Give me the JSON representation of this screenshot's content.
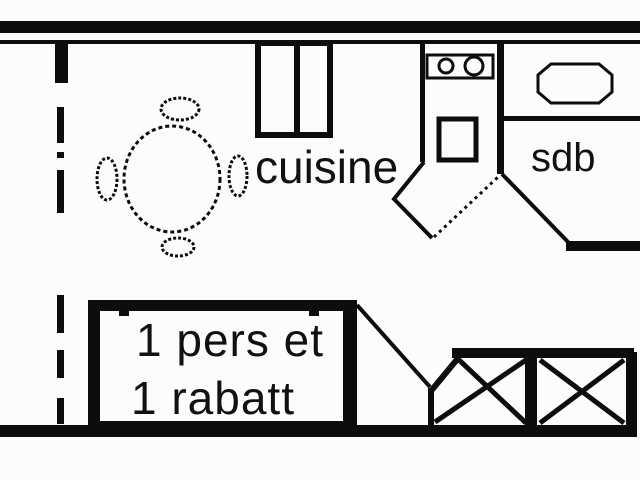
{
  "floorplan": {
    "labels": {
      "kitchen": "cuisine",
      "bathroom": "sdb",
      "bed_line1": "1 pers et",
      "bed_line2": "1 rabatt"
    },
    "colors": {
      "line": "#0d0d0d",
      "background": "#fcfcfc"
    }
  }
}
